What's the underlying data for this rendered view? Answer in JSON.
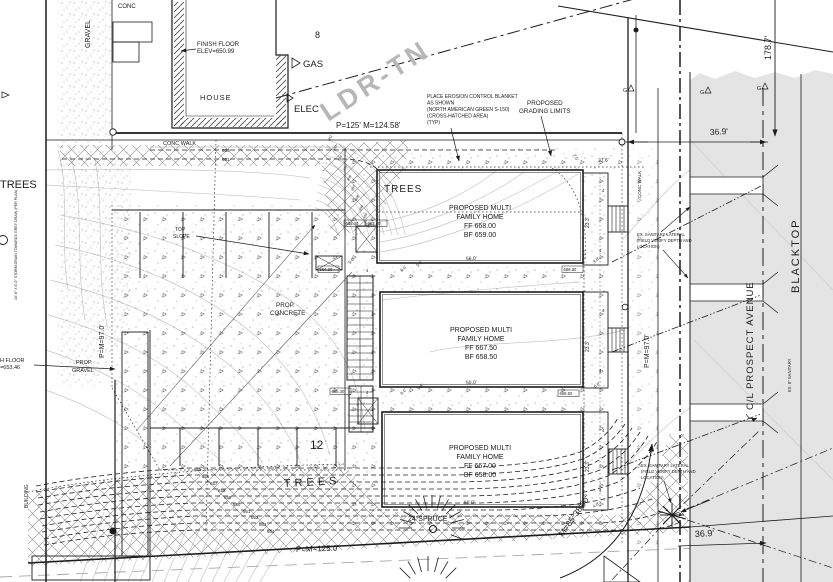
{
  "drawing": {
    "kind": "civil site grading plan"
  },
  "colors": {
    "road": "#e4e4e4",
    "zoning_text": "#b6b6b6",
    "contour_light": "#c6c6c6",
    "ink": "#1c1c1c"
  },
  "texts": {
    "conc": "CONC",
    "gravel": "GRAVEL",
    "house": "HOUSE",
    "house_ff_1": "FINISH FLOOR",
    "house_ff_2": "ELEV=650.99",
    "gas": "GAS",
    "elec": "ELEC",
    "conc_walk": "CONC WALK",
    "conc_walk_v": "CONC WALK",
    "ldr": "LDR-TN",
    "erosion_1": "PLACE EROSION CONTROL BLANKET",
    "erosion_2": "AS SHOWN",
    "erosion_3": "(NORTH AMERICAN GREEN S-150)",
    "erosion_4": "(CROSS-HATCHED AREA)",
    "erosion_5": "(TYP)",
    "grading_1": "PROPOSED",
    "grading_2": "GRADING LIMITS",
    "trees": "TREES",
    "top_1": "TOP",
    "top_2": "SLOPE",
    "prop_concrete_1": "PROP.",
    "prop_concrete_2": "CONCRETE",
    "prop_gravel_1": "PROP.",
    "prop_gravel_2": "GRAVEL",
    "ff_left_1": "FINISH FLOOR",
    "ff_left_2": "ELEV=653.46",
    "building": "BUILDING",
    "spruce": "24\"SPRUCE",
    "bearing": "M=85°38'00\"",
    "cl_prospect": "C/L PROSPECT AVENUE",
    "blacktop": "BLACKTOP",
    "san_1": "EX. SANITARY LATERAL",
    "san_2": "(FIELD VERIFY DEPTH AND",
    "san_3": "LOCATION)",
    "ex8": "EX. 8\" SANITARY",
    "stall_count": "12",
    "storm_note": "10'-6\" X 6'-0\" STORM DRAIN TOWARDS GREY DRAIN (PER PLAN)"
  },
  "dims": {
    "north": "P=125' M=124.58'",
    "south": "P=M=125.0'",
    "west": "P=M=97.0'",
    "east": "P=M=97.0'",
    "row": "178.7'",
    "w_top": "36.9'",
    "w_bottom": "36.9'",
    "b1_top": "27.6'",
    "b1_side": "7.0'"
  },
  "buildings": [
    {
      "name_1": "PROPOSED MULTI",
      "name_2": "FAMILY HOME",
      "ff": "FF 668.00",
      "bf": "BF 659.00",
      "width": "56.0'",
      "depth": "23.3'"
    },
    {
      "name_1": "PROPOSED MULTI",
      "name_2": "FAMILY HOME",
      "ff": "FF 667.50",
      "bf": "BF 658.50",
      "width": "50.0'",
      "depth": "23.3'"
    },
    {
      "name_1": "PROPOSED MULTI",
      "name_2": "FAMILY HOME",
      "ff": "FF 667.00",
      "bf": "BF 658.00",
      "width": "50.0'",
      "depth": "23.3'"
    }
  ],
  "contours": {
    "top": [
      "650",
      "651"
    ],
    "bottom": [
      "655",
      "656",
      "657",
      "658",
      "659",
      "660",
      "661",
      "662",
      "663",
      "664"
    ],
    "fan": [
      "652",
      "653",
      "654",
      "655",
      "656",
      "657",
      "658",
      "659",
      "660",
      "661"
    ]
  },
  "spots": [
    "665.40",
    "663.40",
    "664.30",
    "665.30",
    "668.50",
    "668.30"
  ],
  "small_dims": [
    "6.0'",
    "5.0'",
    "6.0'",
    "5.6'",
    "5.0'",
    "4.0'",
    "6.0'",
    "4.0'"
  ],
  "glyphs": {
    "g": "G",
    "four": "4",
    "eight": "8"
  }
}
